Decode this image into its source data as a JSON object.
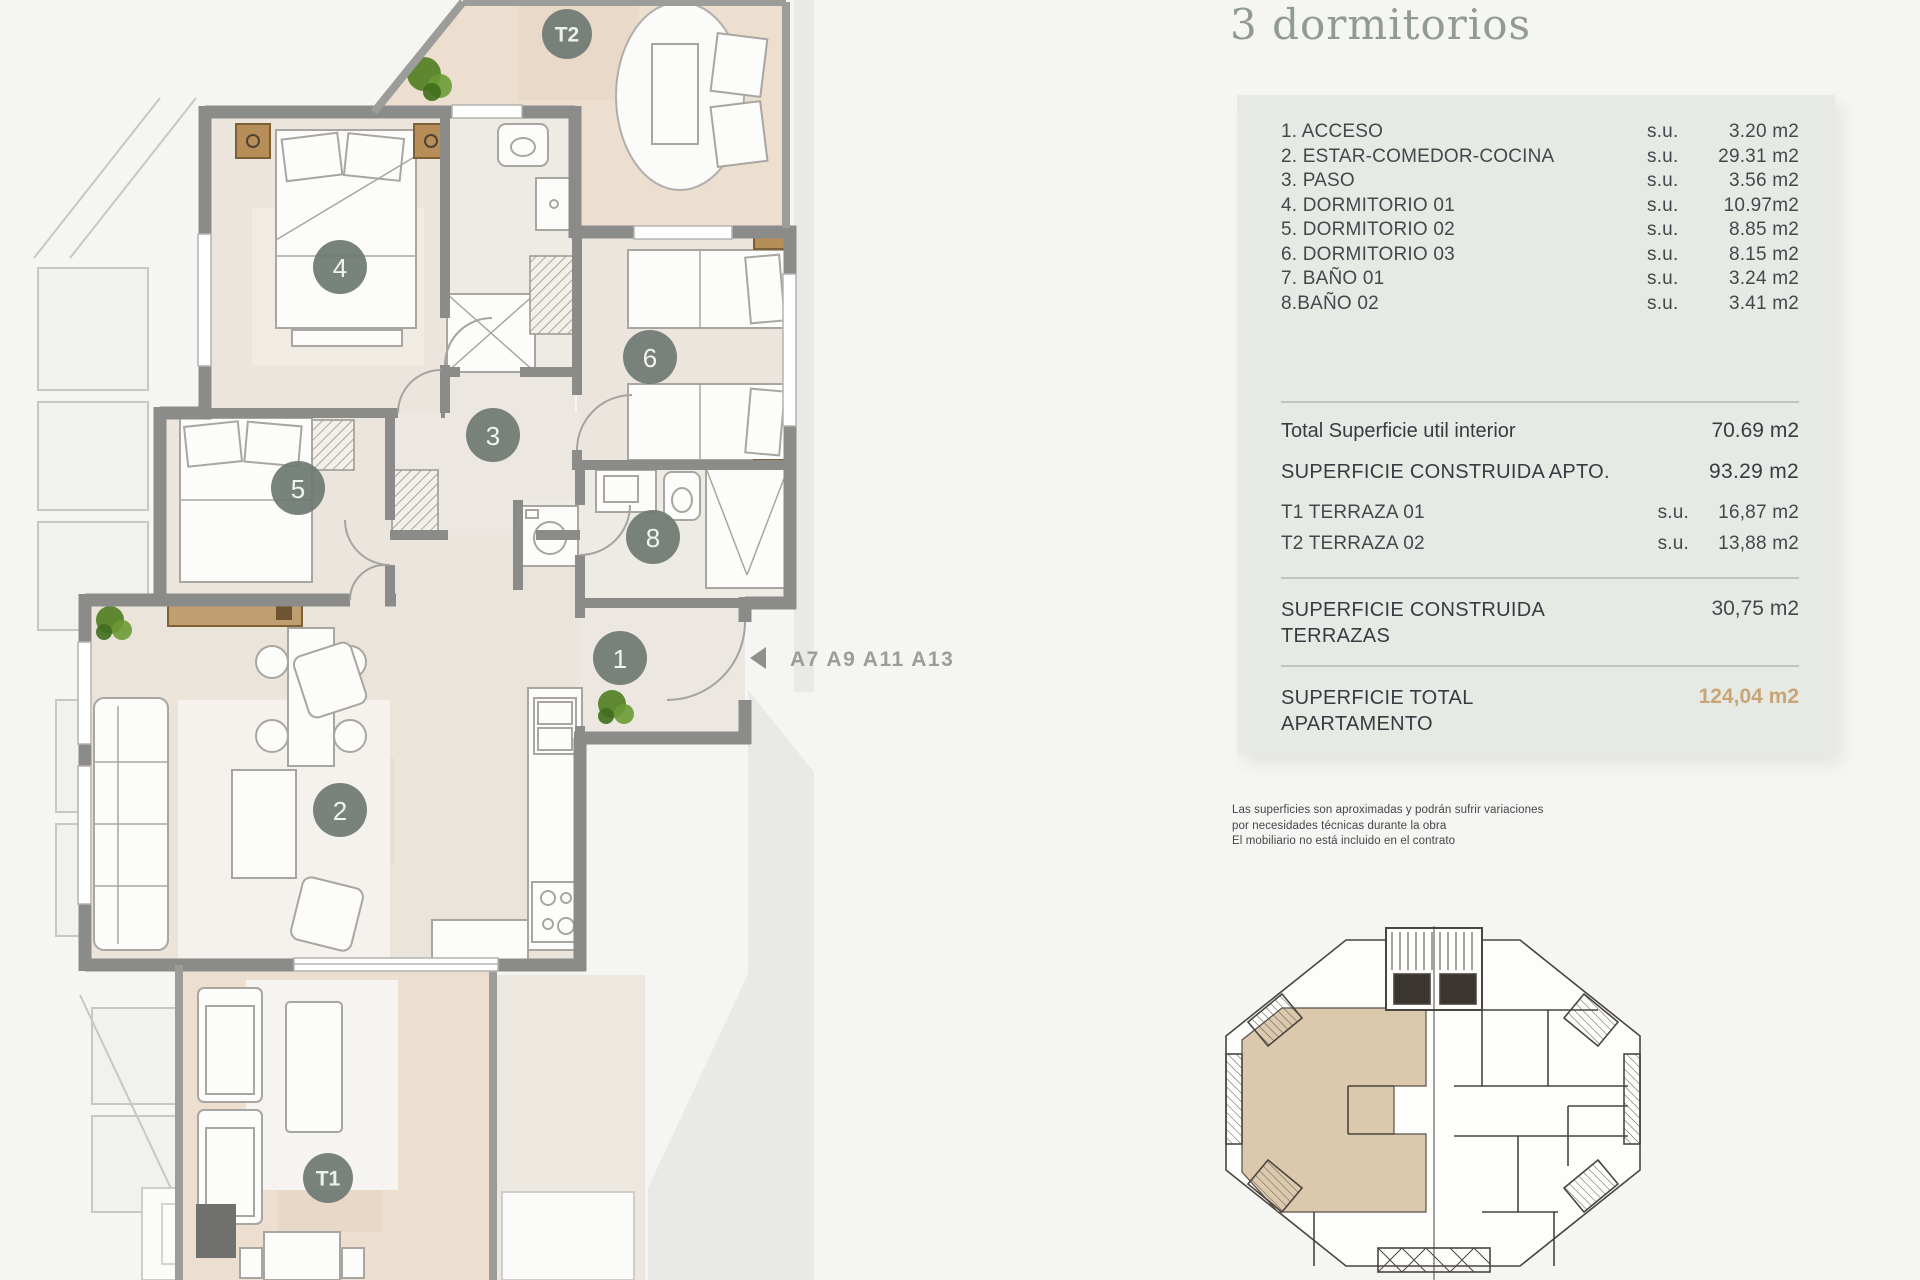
{
  "title": "3 dormitorios",
  "panel": {
    "rooms": [
      {
        "label": "1. ACCESO",
        "su": "s.u.",
        "value": "3.20 m2"
      },
      {
        "label": "2. ESTAR-COMEDOR-COCINA",
        "su": "s.u.",
        "value": "29.31 m2"
      },
      {
        "label": "3. PASO",
        "su": "s.u.",
        "value": "3.56 m2"
      },
      {
        "label": "4. DORMITORIO 01",
        "su": "s.u.",
        "value": "10.97m2"
      },
      {
        "label": "5. DORMITORIO 02",
        "su": "s.u.",
        "value": "8.85 m2"
      },
      {
        "label": "6. DORMITORIO 03",
        "su": "s.u.",
        "value": "8.15 m2"
      },
      {
        "label": "7. BAÑO 01",
        "su": "s.u.",
        "value": "3.24 m2"
      },
      {
        "label": "8.BAÑO 02",
        "su": "s.u.",
        "value": "3.41 m2"
      }
    ],
    "total_util": {
      "label": "Total Superficie util interior",
      "value": "70.69 m2"
    },
    "construida_apto": {
      "label": "SUPERFICIE CONSTRUIDA APTO.",
      "value": "93.29 m2"
    },
    "terraza1": {
      "label": "T1 TERRAZA 01",
      "su": "s.u.",
      "value": "16,87 m2"
    },
    "terraza2": {
      "label": "T2 TERRAZA 02",
      "su": "s.u.",
      "value": "13,88 m2"
    },
    "construida_terrazas": {
      "label_line1": "SUPERFICIE CONSTRUIDA",
      "label_line2": "TERRAZAS",
      "value": "30,75 m2"
    },
    "total_apartamento": {
      "label_line1": "SUPERFICIE TOTAL",
      "label_line2": "APARTAMENTO",
      "value": "124,04 m2"
    }
  },
  "plan": {
    "unit_label": "A7 A9 A11 A13",
    "markers": {
      "a1": "1",
      "a2": "2",
      "a3": "3",
      "a4": "4",
      "a5": "5",
      "a6": "6",
      "a8": "8",
      "t1": "T1",
      "t2": "T2"
    }
  },
  "disclaimer": {
    "line1": "Las superficies son aproximadas y podrán sufrir variaciones",
    "line2": "por necesidades técnicas durante la obra",
    "line3": "El mobiliario no está incluido en el contrato"
  },
  "colors": {
    "accent_total": "#c8a477",
    "panel_bg": "#e7eae4",
    "title": "#919b92",
    "wall": "#8b8b89",
    "floor_interior": "#ebe5dd",
    "floor_terrace": "#ecdfd0",
    "marker": "#6f7a73"
  }
}
